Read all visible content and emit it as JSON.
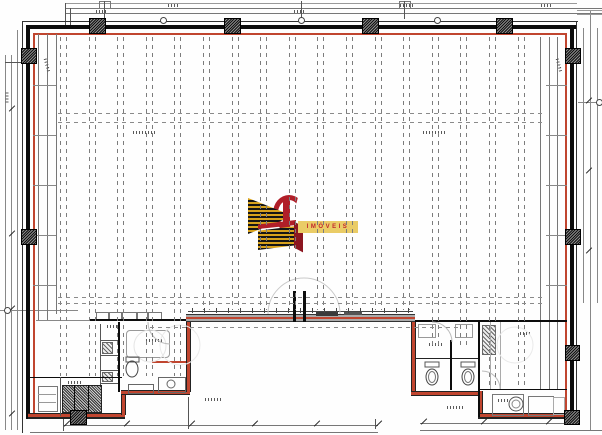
{
  "logo": {
    "banner_text": "IMÓVEIS",
    "colors": {
      "gold": "#d8a21c",
      "dark": "#161616",
      "red": "#b01e28",
      "banner_bg": "#eacc66",
      "banner_text_color": "#c2262c"
    }
  },
  "palette": {
    "outline_red": "#c0452f",
    "wall_black": "#0c0c0c",
    "line_gray": "#555555",
    "dash_gray": "#7c7c7c",
    "band_gray": "#ababab"
  },
  "grid": {
    "start_x": 60,
    "end_x": 520,
    "spacing": 28.6,
    "pair_offset": 6,
    "top": 37,
    "zones": [
      {
        "max_x": 186,
        "bottom": 376
      },
      {
        "max_x": 413,
        "bottom": 310
      },
      {
        "max_x": 480,
        "bottom": 345
      },
      {
        "max_x": 600,
        "bottom": 389
      }
    ],
    "h_dashed": [
      {
        "y": 113,
        "x1": 58,
        "x2": 546
      },
      {
        "y": 122,
        "x1": 58,
        "x2": 546
      },
      {
        "y": 297,
        "x1": 58,
        "x2": 546
      },
      {
        "y": 303,
        "x1": 58,
        "x2": 546
      },
      {
        "y": 327,
        "x1": 150,
        "x2": 460
      }
    ],
    "rung_ys": [
      85,
      135,
      185,
      235,
      285
    ],
    "rung_left": {
      "x": 33,
      "w": 23
    },
    "rung_right": {
      "x": 546,
      "w": 21
    }
  },
  "columns": [
    [
      89,
      18,
      15,
      14
    ],
    [
      224,
      18,
      15,
      14
    ],
    [
      362,
      18,
      15,
      14
    ],
    [
      496,
      18,
      15,
      14
    ],
    [
      21,
      48,
      14,
      14
    ],
    [
      21,
      229,
      14,
      14
    ],
    [
      565,
      48,
      14,
      14
    ],
    [
      565,
      229,
      14,
      14
    ],
    [
      565,
      345,
      13,
      14
    ],
    [
      70,
      410,
      15,
      13
    ],
    [
      564,
      410,
      14,
      13
    ]
  ],
  "curb": {
    "y": 308,
    "h": 5,
    "x1": 192,
    "x2": 410,
    "step": 12
  },
  "dim_ticks": [
    [
      63,
      423
    ],
    [
      123,
      423
    ],
    [
      188,
      423
    ],
    [
      251,
      423
    ],
    [
      313,
      423
    ],
    [
      375,
      423
    ],
    [
      420,
      421
    ],
    [
      480,
      421
    ],
    [
      545,
      421
    ],
    [
      563,
      421
    ],
    [
      8,
      108
    ],
    [
      8,
      233
    ],
    [
      8,
      308
    ],
    [
      8,
      413
    ],
    [
      585,
      100
    ],
    [
      585,
      170
    ],
    [
      585,
      250
    ]
  ],
  "bubbles": [
    [
      163,
      20
    ],
    [
      301,
      20
    ],
    [
      437,
      20
    ],
    [
      7,
      310
    ],
    [
      599,
      102
    ]
  ]
}
